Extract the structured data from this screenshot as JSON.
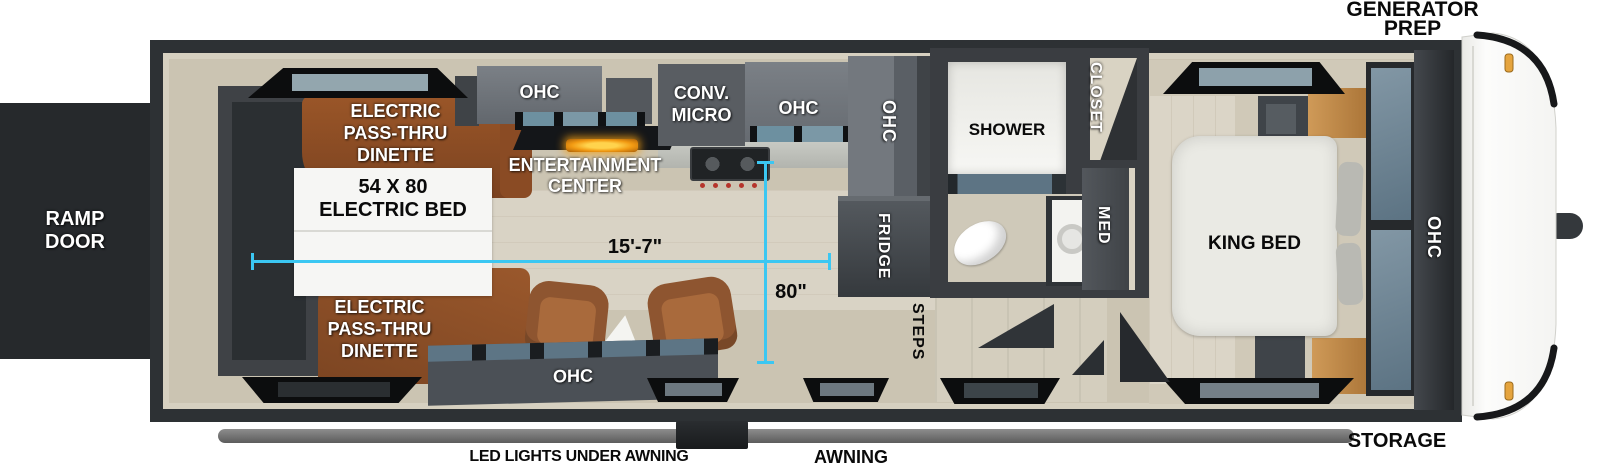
{
  "exterior": {
    "generator_prep": [
      "GENERATOR",
      "PREP"
    ],
    "ramp_door": [
      "RAMP",
      "DOOR"
    ],
    "storage": "STORAGE",
    "awning": "AWNING",
    "led_lights": "LED LIGHTS UNDER AWNING"
  },
  "living": {
    "dinette_top": [
      "ELECTRIC",
      "PASS-THRU",
      "DINETTE"
    ],
    "electric_bed": [
      "54 X 80",
      "ELECTRIC BED"
    ],
    "entertainment": [
      "ENTERTAINMENT",
      "CENTER"
    ],
    "dinette_bottom": [
      "ELECTRIC",
      "PASS-THRU",
      "DINETTE"
    ],
    "ohc_island": "OHC"
  },
  "kitchen": {
    "ohc_left": "OHC",
    "conv_micro": [
      "CONV.",
      "MICRO"
    ],
    "ohc_right": "OHC",
    "ohc_tall": "OHC",
    "fridge": "FRIDGE"
  },
  "bath": {
    "shower": "SHOWER",
    "closet": "CLOSET",
    "med": "MED",
    "steps": "STEPS"
  },
  "bedroom": {
    "king_bed": "KING BED",
    "ohc_front": "OHC"
  },
  "dimensions": {
    "length": "15'-7\"",
    "width": "80\""
  },
  "colors": {
    "accent_cyan": "#3bc7f2",
    "wall_dark": "#2d3134",
    "floor_beige": "#cbc4b2",
    "cabinet_gray": "#6f747a",
    "dinette_brown": "#8e4e26",
    "label_white": "#ffffff",
    "label_black": "#0a0a0a"
  }
}
